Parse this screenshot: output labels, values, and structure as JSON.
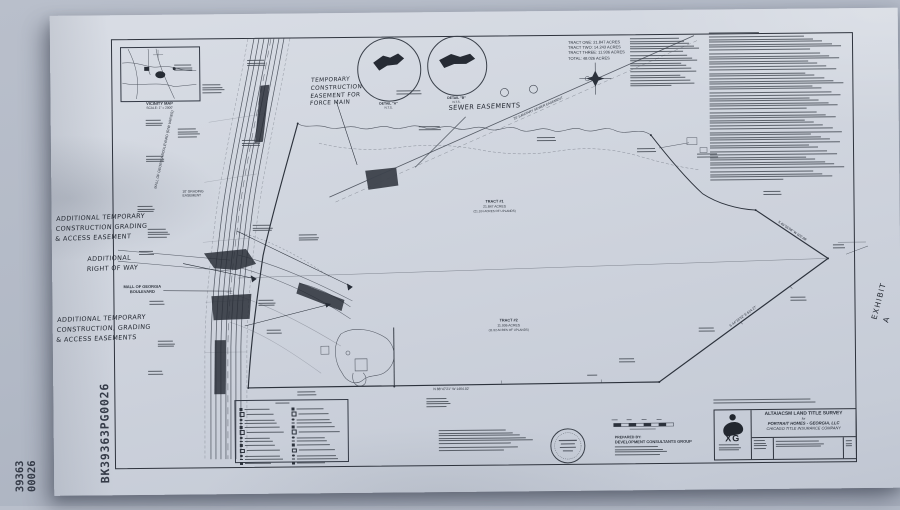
{
  "photo": {
    "backdrop": "#aeb5c3",
    "paper": "#cfd4de",
    "ink": "#343a45",
    "hand_ink": "#1f242d"
  },
  "stamps": {
    "book_page": "BK39363PG0026",
    "doc_no_top": "39363",
    "doc_no_bottom": "00026",
    "exhibit": "EXHIBIT A"
  },
  "vicinity": {
    "title": "VICINITY MAP",
    "scale": "SCALE: 1\" = 2000'"
  },
  "details": {
    "a": [
      "DETAIL \"A\"",
      "N.T.S."
    ],
    "b": [
      "DETAIL \"B\"",
      "N.T.S."
    ]
  },
  "handwritten": {
    "temp_note": [
      "TEMPORARY",
      "CONSTRUCTION",
      "EASEMENT FOR",
      "FORCE MAIN"
    ],
    "sewer_note": "SEWER EASEMENTS",
    "note_a": [
      "ADDITIONAL TEMPORARY",
      "CONSTRUCTION GRADING",
      "& ACCESS EASEMENT"
    ],
    "note_b": [
      "ADDITIONAL",
      "RIGHT OF WAY"
    ],
    "note_c": [
      "ADDITIONAL TEMPORARY",
      "CONSTRUCTION, GRADING",
      "& ACCESS EASEMENTS"
    ]
  },
  "summary": {
    "lines": [
      "TRACT ONE: 21.847 ACRES",
      "TRACT TWO: 14.243 ACRES",
      "TRACT THREE: 11.936 ACRES",
      "TOTAL: 48.026 ACRES"
    ]
  },
  "map": {
    "road_label": [
      "MALL OF GEORGIA",
      "BOULEVARD"
    ],
    "road_label_rotated": "MALL OF GEORGIA BOULEVARD (R/W VARIES)",
    "grading_easement": [
      "10' GRADING",
      "EASEMENT"
    ],
    "tract1": [
      "TRACT #1",
      "21.847 ACRES",
      "(21.104 ACRES OF UPLANDS)"
    ],
    "tract2": [
      "TRACT #2",
      "11.936 ACRES",
      "(11.52 ACRES OF UPLANDS)"
    ],
    "sewer_line_label": "20' SANITARY SEWER EASEMENT",
    "bearing_se": "S 44°18'32\" E  614.27'",
    "bearing_sw": "S 46°55'08\" W  602.88'",
    "south_line": "N 88°47'21\" W  1464.02'"
  },
  "prepared_by": {
    "heading": "PREPARED BY:",
    "company": "DEVELOPMENT CONSULTANTS GROUP"
  },
  "title_block": {
    "line_type": "ALTA/ACSM LAND TITLE SURVEY",
    "for_word": "for",
    "client": "PORTRAIT HOMES - GEORGIA, LLC",
    "underwriter": "CHICAGO TITLE INSURANCE COMPANY",
    "logo": "XG"
  }
}
